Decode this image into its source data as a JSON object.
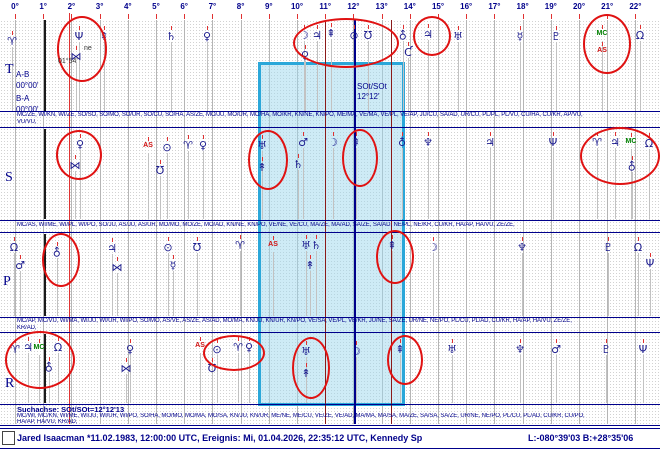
{
  "ruler": {
    "degree_labels": [
      "0°",
      "1°",
      "2°",
      "3°",
      "4°",
      "5°",
      "6°",
      "7°",
      "8°",
      "9°",
      "10°",
      "11°",
      "12°",
      "13°",
      "14°",
      "15°",
      "16°",
      "17°",
      "18°",
      "19°",
      "20°",
      "21°",
      "22°"
    ]
  },
  "rows": {
    "t": "T",
    "s": "S",
    "p": "P",
    "r": "R"
  },
  "left_panel": {
    "ab_label": "A-B",
    "ab_value": "00°00'",
    "ba_label": "B-A",
    "ba_value": "00°00'"
  },
  "search_axis": {
    "box_label_line1": "SOt/SOt",
    "box_label_line2": "12°12'",
    "footer": "Suchachse: SOt/SOt=12°12'13"
  },
  "event_marker": {
    "name": "ne",
    "position": "01°54'"
  },
  "statusbar": {
    "subject": "Jared Isaacman  *11.02.1983, 12:00:00 UTC, Ereignis: Mi, 01.04.2026, 22:35:12 UTC, Kennedy Sp",
    "coordinates": "L:-080°39'03 B:+28°35'06"
  },
  "colors": {
    "navy": "#00008b",
    "glyph_blue": "#1b1b8e",
    "circle_red": "#e01212",
    "bright_red": "#e03131",
    "maroon": "#8b1a1a",
    "green": "#008000",
    "grid_gray": "#b5b5b5",
    "box_border": "#2aa7d9",
    "box_fill": "rgba(158,216,238,0.5)"
  },
  "bands": {
    "t": {
      "top": 20,
      "bottom": 111,
      "midpoints_line1": "MC/ZE, WI/KN, WI/ZE, SO/SO, SO/MO, SO/UR, SO/CU, SO/HA, AS/ZE, MO/JU, MO/UR, MO/HA, MO/KR, KN/NE, KN/PO, ME/MA, VE/MA, VE/PL, VE/AP, JU/CU, SA/AD, UR/CU, PL/PL, PL/VU, CU/HA, CU/KR, AP/VU,",
      "midpoints_line2": "VU/VU,",
      "glyphs": [
        {
          "g": "aries",
          "x": 12,
          "y": 36
        },
        {
          "g": "neptune",
          "x": 79,
          "y": 31
        },
        {
          "g": "bowtie",
          "x": 76,
          "y": 51
        },
        {
          "g": "zeusB",
          "x": 104,
          "y": 31
        },
        {
          "g": "saturn",
          "x": 171,
          "y": 31
        },
        {
          "g": "venus",
          "x": 207,
          "y": 31
        },
        {
          "g": "moon",
          "x": 304,
          "y": 30
        },
        {
          "g": "jupiter",
          "x": 317,
          "y": 30
        },
        {
          "g": "zeusB",
          "x": 331,
          "y": 28
        },
        {
          "g": "sun",
          "x": 354,
          "y": 30
        },
        {
          "g": "hades",
          "x": 368,
          "y": 30
        },
        {
          "g": "venus",
          "x": 305,
          "y": 50
        },
        {
          "g": "vulkanus",
          "x": 403,
          "y": 30
        },
        {
          "g": "cupido",
          "x": 408,
          "y": 47
        },
        {
          "g": "kronos",
          "x": 428,
          "y": 29
        },
        {
          "g": "uranus",
          "x": 458,
          "y": 31
        },
        {
          "g": "mercury",
          "x": 520,
          "y": 31
        },
        {
          "g": "pluto",
          "x": 556,
          "y": 31
        },
        {
          "g": "mc",
          "x": 602,
          "y": 30
        },
        {
          "g": "as",
          "x": 602,
          "y": 47
        },
        {
          "g": "node",
          "x": 640,
          "y": 30
        }
      ]
    },
    "s": {
      "top": 129,
      "bottom": 219,
      "midpoints_line1": "MC/AS, WI/ME, WI/PL, WI/PO, SO/JU, AS/JU, AS/UR, MO/MO, MO/ZE, MO/AD, KN/NE, KN/PO, VE/NE, VE/CU, MA/ZE, MA/AD, SA/ZE, SA/AD, NE/PL, NE/KR, CU/KR, HA/AP, HA/VU, ZE/ZE,",
      "midpoints_line2": "",
      "glyphs": [
        {
          "g": "venus",
          "x": 80,
          "y": 139
        },
        {
          "g": "bowtie",
          "x": 75,
          "y": 160
        },
        {
          "g": "as",
          "x": 148,
          "y": 142
        },
        {
          "g": "sun",
          "x": 167,
          "y": 142
        },
        {
          "g": "hades",
          "x": 160,
          "y": 165
        },
        {
          "g": "aries",
          "x": 188,
          "y": 140
        },
        {
          "g": "venus",
          "x": 203,
          "y": 140
        },
        {
          "g": "uranus",
          "x": 262,
          "y": 140
        },
        {
          "g": "zeusA",
          "x": 262,
          "y": 162
        },
        {
          "g": "mars",
          "x": 303,
          "y": 137
        },
        {
          "g": "saturn",
          "x": 298,
          "y": 159
        },
        {
          "g": "moon",
          "x": 333,
          "y": 137
        },
        {
          "g": "zeusB",
          "x": 356,
          "y": 137
        },
        {
          "g": "admetos",
          "x": 402,
          "y": 137
        },
        {
          "g": "poseidon",
          "x": 428,
          "y": 137
        },
        {
          "g": "jupiter",
          "x": 490,
          "y": 137
        },
        {
          "g": "neptune",
          "x": 553,
          "y": 137
        },
        {
          "g": "aries",
          "x": 597,
          "y": 137
        },
        {
          "g": "jupiter",
          "x": 615,
          "y": 137
        },
        {
          "g": "mc",
          "x": 631,
          "y": 138
        },
        {
          "g": "node",
          "x": 649,
          "y": 138
        },
        {
          "g": "vulkanus",
          "x": 632,
          "y": 161
        }
      ]
    },
    "p": {
      "top": 234,
      "bottom": 316,
      "midpoints_line1": "MC/AP, MC/VU, WI/MA, WI/JU, WI/UR, WI/PO, SO/MO, AS/VE, AS/ZE, AS/AD, MO/MA, KN/JU, KN/UR, KN/PO, VE/SA, VE/PL, VE/KR, JU/NE, SA/ZE, UR/NE, NE/PO, PL/CU, PL/AD, CU/KR, HA/AP, HA/VU, ZE/ZE,",
      "midpoints_line2": "KR/AD,",
      "glyphs": [
        {
          "g": "node",
          "x": 14,
          "y": 242
        },
        {
          "g": "mars",
          "x": 20,
          "y": 260
        },
        {
          "g": "vulkanus",
          "x": 57,
          "y": 247
        },
        {
          "g": "jupiter",
          "x": 112,
          "y": 243
        },
        {
          "g": "bowtie",
          "x": 117,
          "y": 262
        },
        {
          "g": "sun",
          "x": 168,
          "y": 242
        },
        {
          "g": "mercury",
          "x": 173,
          "y": 260
        },
        {
          "g": "hades",
          "x": 197,
          "y": 242
        },
        {
          "g": "aries",
          "x": 240,
          "y": 240
        },
        {
          "g": "as",
          "x": 273,
          "y": 241
        },
        {
          "g": "uranus",
          "x": 306,
          "y": 240
        },
        {
          "g": "saturn",
          "x": 316,
          "y": 240
        },
        {
          "g": "zeusA",
          "x": 310,
          "y": 260
        },
        {
          "g": "zeusB",
          "x": 392,
          "y": 240
        },
        {
          "g": "moon",
          "x": 433,
          "y": 242
        },
        {
          "g": "poseidon",
          "x": 522,
          "y": 242
        },
        {
          "g": "pluto",
          "x": 608,
          "y": 242
        },
        {
          "g": "node",
          "x": 638,
          "y": 242
        },
        {
          "g": "neptune",
          "x": 650,
          "y": 258
        }
      ]
    },
    "r": {
      "top": 334,
      "bottom": 403,
      "midpoints_line1": "MC/WI, MC/KN, WI/ME, WI/JU, WI/UR, WI/PO, SO/HA, MO/MO, MO/MA, MO/SA, KN/JU, KN/UR, ME/NE, ME/CU, VE/ZE, VE/AD, MA/MA, MA/SA, MA/ZE, SA/SA, SA/ZE, UR/NE, NE/PO, PL/CU, PL/AD, CU/KR, CU/PO,",
      "midpoints_line2": "HA/AP, HA/VU, KR/AD,",
      "glyphs": [
        {
          "g": "aries",
          "x": 15,
          "y": 344
        },
        {
          "g": "jupiter",
          "x": 28,
          "y": 342
        },
        {
          "g": "mc",
          "x": 39,
          "y": 344
        },
        {
          "g": "node",
          "x": 58,
          "y": 342
        },
        {
          "g": "vulkanus",
          "x": 49,
          "y": 362
        },
        {
          "g": "venus",
          "x": 130,
          "y": 344
        },
        {
          "g": "bowtie",
          "x": 126,
          "y": 363
        },
        {
          "g": "as",
          "x": 200,
          "y": 342
        },
        {
          "g": "sun",
          "x": 217,
          "y": 344
        },
        {
          "g": "aries",
          "x": 238,
          "y": 342
        },
        {
          "g": "venus",
          "x": 249,
          "y": 342
        },
        {
          "g": "hades",
          "x": 212,
          "y": 363
        },
        {
          "g": "uranus",
          "x": 306,
          "y": 346
        },
        {
          "g": "zeusA",
          "x": 306,
          "y": 368
        },
        {
          "g": "moon",
          "x": 356,
          "y": 346
        },
        {
          "g": "zeusB",
          "x": 400,
          "y": 344
        },
        {
          "g": "uranus",
          "x": 452,
          "y": 344
        },
        {
          "g": "poseidon",
          "x": 520,
          "y": 344
        },
        {
          "g": "mars",
          "x": 556,
          "y": 344
        },
        {
          "g": "pluto",
          "x": 606,
          "y": 344
        },
        {
          "g": "neptune",
          "x": 643,
          "y": 344
        }
      ]
    }
  },
  "chart_data": {
    "type": "graphic-ephemeris-22.5-degree-sort",
    "ruler_origin_x": 15,
    "ruler_step_px": 28.2,
    "search_box": {
      "x": 258,
      "y": 62,
      "w": 141,
      "h": 338
    },
    "event_marker_pos": {
      "glyph_x": 76,
      "name_x": 84,
      "name_y": 45,
      "pos_x": 58,
      "pos_y": 58
    },
    "vlines": [
      {
        "x": 69,
        "c": "bright_red",
        "w": 1,
        "y1": 13,
        "y2": 424
      },
      {
        "x": 325,
        "c": "maroon",
        "w": 1,
        "y1": 20,
        "y2": 424
      },
      {
        "x": 354,
        "c": "navy",
        "w": 2,
        "y1": 20,
        "y2": 424
      },
      {
        "x": 391,
        "c": "maroon",
        "w": 1,
        "y1": 20,
        "y2": 424
      }
    ],
    "hlines": [
      111,
      127,
      220,
      232,
      317,
      332,
      404,
      425,
      428,
      448
    ],
    "circles": [
      {
        "x": 57,
        "y": 16,
        "w": 46,
        "h": 62
      },
      {
        "x": 293,
        "y": 18,
        "w": 102,
        "h": 46
      },
      {
        "x": 413,
        "y": 16,
        "w": 34,
        "h": 36
      },
      {
        "x": 583,
        "y": 14,
        "w": 44,
        "h": 56
      },
      {
        "x": 56,
        "y": 130,
        "w": 42,
        "h": 46
      },
      {
        "x": 248,
        "y": 130,
        "w": 36,
        "h": 56
      },
      {
        "x": 342,
        "y": 129,
        "w": 32,
        "h": 54
      },
      {
        "x": 580,
        "y": 127,
        "w": 76,
        "h": 54
      },
      {
        "x": 42,
        "y": 233,
        "w": 34,
        "h": 50
      },
      {
        "x": 376,
        "y": 230,
        "w": 34,
        "h": 50
      },
      {
        "x": 5,
        "y": 331,
        "w": 66,
        "h": 54
      },
      {
        "x": 203,
        "y": 335,
        "w": 58,
        "h": 32
      },
      {
        "x": 292,
        "y": 337,
        "w": 34,
        "h": 58
      },
      {
        "x": 387,
        "y": 335,
        "w": 32,
        "h": 46
      }
    ],
    "row_letter_pos": {
      "t": [
        5,
        62
      ],
      "s": [
        5,
        170
      ],
      "p": [
        3,
        274
      ],
      "r": [
        5,
        376
      ]
    },
    "midline_y": {
      "t": [
        112,
        119
      ],
      "s": [
        222,
        0
      ],
      "p": [
        318,
        325
      ],
      "r": [
        413,
        419
      ]
    }
  }
}
